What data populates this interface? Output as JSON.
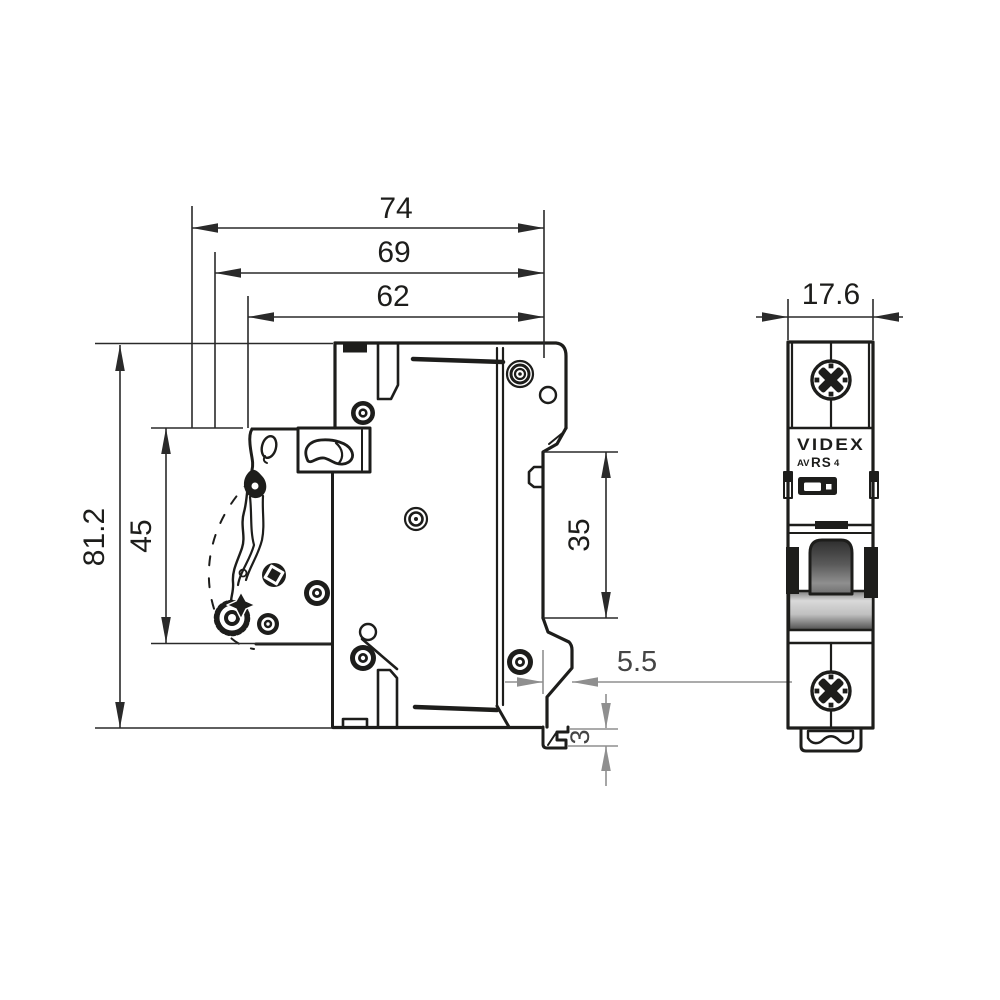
{
  "colors": {
    "ink": "#1d1d1b",
    "secondary_dim": "#8f8f8f",
    "background": "#ffffff",
    "toggle_dark": "#2e2e2e",
    "toggle_light": "#d9d9d9"
  },
  "side_view": {
    "dims": {
      "overall_depth": "74",
      "depth_to_toggle": "69",
      "body_depth": "62",
      "overall_height": "81.2",
      "front_section_height": "45",
      "din_rail_cutout": "35",
      "clip_protrusion": "5.5",
      "clip_foot_height": "3"
    }
  },
  "front_view": {
    "dims": {
      "module_width": "17.6"
    },
    "label": {
      "brand": "VIDEX",
      "model_prefix": "AV",
      "model_series": "RS",
      "model_number": "4"
    }
  }
}
